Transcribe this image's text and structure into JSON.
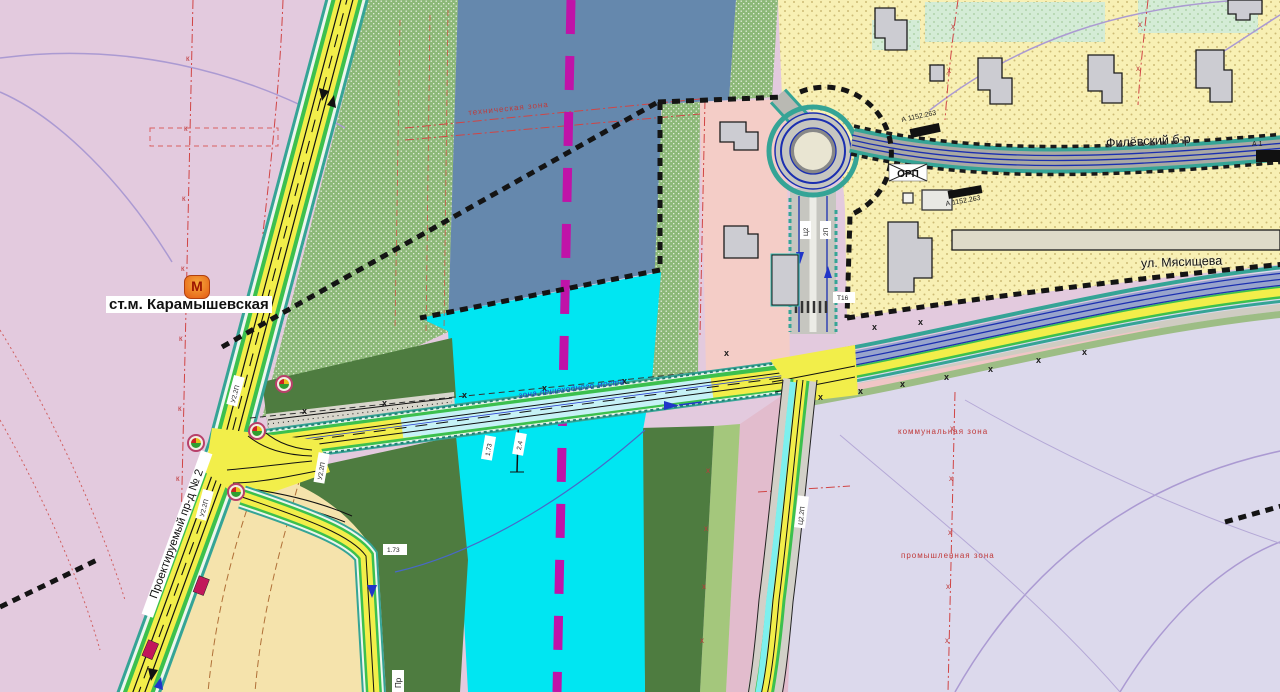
{
  "labels": {
    "station": "ст.м. Карамышевская",
    "metro_letter": "М",
    "street_filyovsky": "Филёвский б-р",
    "street_myasishcheva": "ул. Мясищева",
    "road_projected": "Проектируемый пр-д № 2",
    "road_projected_abbrev": "Пр",
    "zone_pedestrian_bridge": "зона пешеходного моста",
    "zone_technical": "техническая зона",
    "zone_communal": "коммунальная зона",
    "zone_industrial": "промышленная зона",
    "orp": "ОРП",
    "axis_a1": "А 1152.263",
    "axis_a2": "А 1152.263",
    "axis_a3": "А 1",
    "mark_u22p": "У2.2П",
    "mark_c22p": "Ц2.2П",
    "mark_c2": "Ц2",
    "mark_2p": "2П",
    "mark_173": "1.73",
    "mark_24": "2.4",
    "mark_t16": "Т16",
    "k_mark": "к",
    "x_mark": "х"
  },
  "colors": {
    "water_deep": "#6588ad",
    "water_channel": "#00e6f2",
    "boundary_dashed": "#141414",
    "city_line_magenta": "#c013a8",
    "road_surface_yellow": "#f2ee4a",
    "greenery_strip": "#3cc04e",
    "curb_teal": "#35a496",
    "zone_mauve": "#e3cade",
    "zone_residential_yellow": "#f8f0b4",
    "zone_lavender": "#dcd9ec",
    "zone_pink": "#f4cdc7",
    "park_green_dotted": "#8cb878",
    "forest_green": "#4e7c40",
    "lane_line_navy": "#1b2fb0",
    "metro_icon_bg": "#f08a2e",
    "metro_icon_letter": "#9c1400",
    "mark_red": "#c03a3a"
  }
}
